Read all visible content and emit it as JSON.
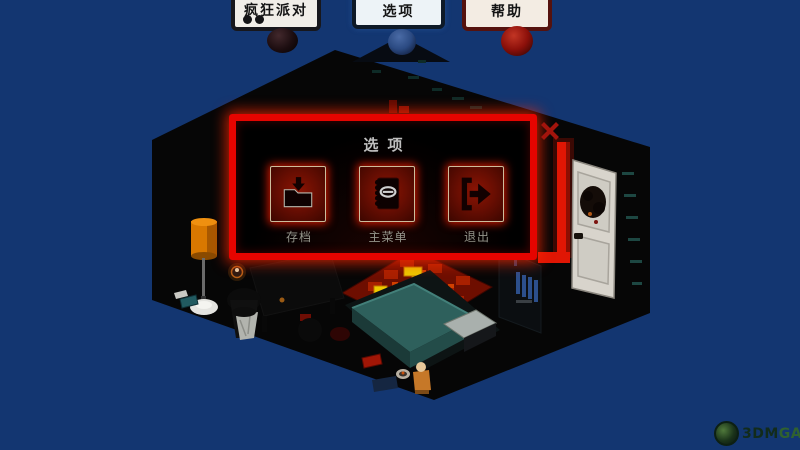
{
  "colors": {
    "background": "#133671",
    "dialog_border": "#e60400",
    "button_face": "#7a1104",
    "card1_border": "#17171c",
    "card2_border": "#0e1a28",
    "card3_border": "#55120e",
    "orb_dark": "#1c0d10",
    "orb_blue": "#2b4a82",
    "orb_red": "#8c100a",
    "rug_red": "#7e1000",
    "rug_yellow": "#ecc800",
    "bed_teal": "#2e605c",
    "lamp_orange": "#d97800",
    "door_white": "#d8d4cc"
  },
  "top_cards": [
    {
      "text": "疯狂派对",
      "dot_count": 2
    },
    {
      "text": "选项"
    },
    {
      "text": "帮助"
    }
  ],
  "dialog": {
    "title": "选项",
    "buttons": [
      {
        "label": "存档",
        "icon": "folder-download-icon"
      },
      {
        "label": "主菜单",
        "icon": "notebook-icon"
      },
      {
        "label": "退出",
        "icon": "exit-right-icon"
      }
    ]
  },
  "watermark": {
    "brand": "3DM",
    "suffix": "GAME"
  },
  "scene": {
    "items": [
      "isometric-room",
      "bed",
      "pillow",
      "red-rug",
      "floor-lamp",
      "trash-bin",
      "bookshelf",
      "white-door",
      "door-wreath",
      "desk",
      "red-wall-pipe",
      "candle",
      "bedside-items"
    ]
  }
}
